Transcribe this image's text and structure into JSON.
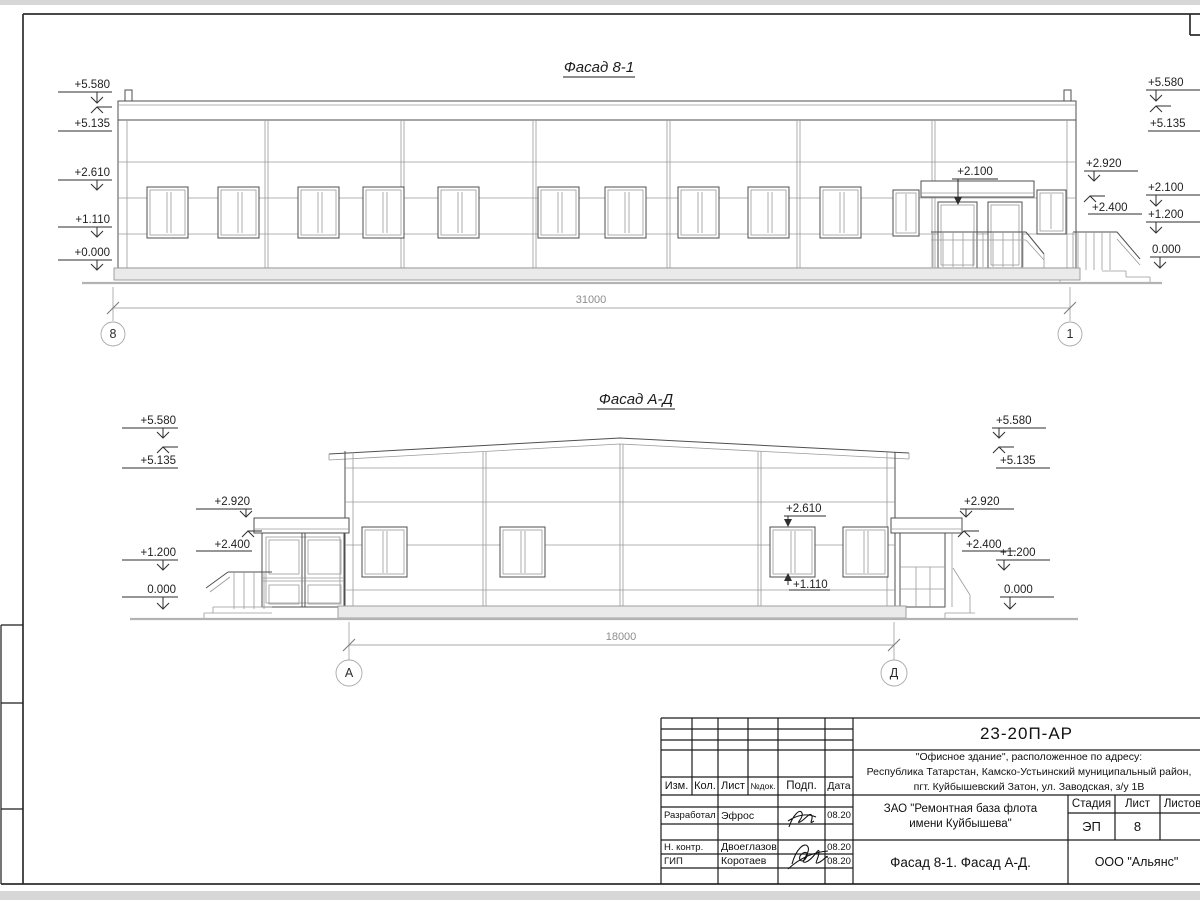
{
  "drawing": {
    "facade1": {
      "title": "Фасад 8-1",
      "dimension": "31000",
      "axis_left": "8",
      "axis_right": "1",
      "marks_left": [
        "+5.580",
        "+5.135",
        "+2.610",
        "+1.110",
        "+0.000"
      ],
      "marks_right": [
        "+5.580",
        "+5.135",
        "+2.920",
        "+2.100",
        "+2.400",
        "+1.200",
        "0.000"
      ],
      "entrance_mark": "+2.100"
    },
    "facade2": {
      "title": "Фасад А-Д",
      "dimension": "18000",
      "axis_left": "А",
      "axis_right": "Д",
      "marks_left": [
        "+5.580",
        "+5.135",
        "+2.920",
        "+2.400",
        "+1.200",
        "0.000"
      ],
      "marks_right": [
        "+5.580",
        "+5.135",
        "+2.920",
        "+2.400",
        "+1.200",
        "0.000"
      ],
      "window_top_mark": "+2.610",
      "window_sill_mark": "+1.110"
    }
  },
  "titleblock": {
    "doc_number": "23-20П-АР",
    "project_lines": [
      "\"Офисное здание\", расположенное по адресу:",
      "Республика Татарстан, Камско-Устьинский муниципальный район,",
      "пгт. Куйбышевский Затон, ул. Заводская, з/у 1В"
    ],
    "client_lines": [
      "ЗАО \"Ремонтная база флота",
      "имени Куйбышева\""
    ],
    "sheet_title": "Фасад 8-1. Фасад А-Д.",
    "organization": "ООО \"Альянс\"",
    "header_cols": [
      "Изм.",
      "Кол.",
      "Лист",
      "№док.",
      "Подп.",
      "Дата"
    ],
    "stage_label": "Стадия",
    "sheet_label": "Лист",
    "sheets_label": "Листов",
    "stage_value": "ЭП",
    "sheet_value": "8",
    "rows": [
      {
        "role": "Разработал",
        "name": "Эфрос",
        "date": "08.20"
      },
      {
        "role": "Н. контр.",
        "name": "Двоеглазов",
        "date": "08.20"
      },
      {
        "role": "ГИП",
        "name": "Коротаев",
        "date": "08.20"
      }
    ]
  }
}
